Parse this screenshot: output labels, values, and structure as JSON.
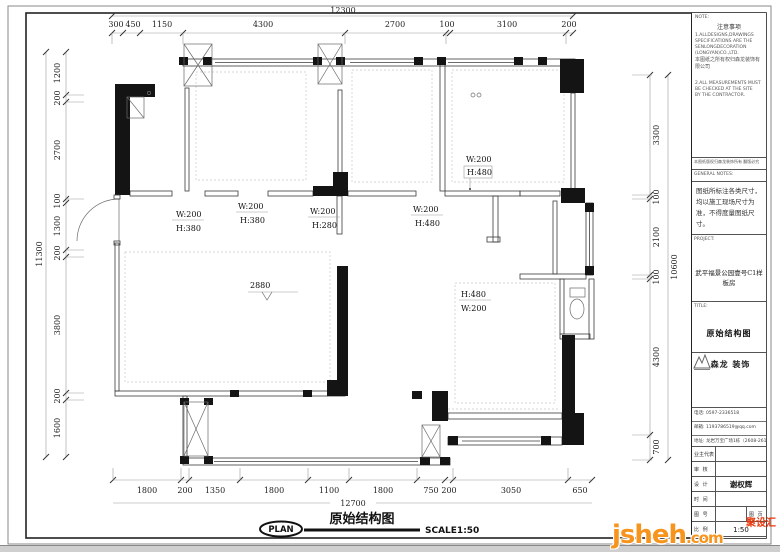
{
  "sheet": {
    "plan": {
      "title": "原始结构图",
      "plan_badge": "PLAN",
      "scale_note": "SCALE1:50",
      "floor_height": "2880",
      "wall_labels": [
        {
          "w": "W:200",
          "h": "H:380"
        },
        {
          "w": "W:200",
          "h": "H:380"
        },
        {
          "w": "W:200",
          "h": "H:280"
        },
        {
          "w": "W:200",
          "h": "H:480"
        },
        {
          "w": "W:200",
          "h": "H:480"
        },
        {
          "w": "W:200",
          "h": "H:480"
        }
      ],
      "dims": {
        "top_total": "12300",
        "top": [
          "300",
          "450",
          "1150",
          "4300",
          "2700",
          "100",
          "3100",
          "200"
        ],
        "left_total": "11300",
        "left": [
          "1200",
          "200",
          "2700",
          "100",
          "1300",
          "200",
          "3800",
          "200",
          "1600"
        ],
        "right_total": "10600",
        "right": [
          "3300",
          "100",
          "2100",
          "100",
          "4300",
          "700"
        ],
        "bottom_total": "12700",
        "bottom": [
          "1800",
          "200",
          "1350",
          "1800",
          "1100",
          "1800",
          "750",
          "200",
          "3050",
          "650"
        ]
      }
    },
    "titleblock": {
      "note_label": "NOTE:",
      "note_title": "注意事项",
      "note_lines": [
        "1.ALLDESIGNS,DRAWINGS",
        "SPECIFICATIONS ARE THE",
        "SENLONGDECORATION",
        "(LONGYAN)CO.,LTD.",
        "本图纸之所有权归森龙装饰有限公司",
        "",
        "2.ALL MEASUREMENTS MUST",
        "BE CHECKED AT THE SITE",
        "BY THE CONTRACTOR."
      ],
      "copyright_line": "本图纸版权归森龙装饰所有 翻版必究",
      "general_notes_label": "GENERAL NOTES:",
      "general_notes": "图纸所标注各类尺寸，均以施工现场尺寸为准，不得度量图纸尺寸。",
      "project_label": "PROJECT:",
      "project_name": "武平福景公园壹号C1样板房",
      "title_label": "TITLE:",
      "drawing_title": "原始结构图",
      "company_name": "森龙 装饰",
      "contacts": {
        "phone": "电话: 0597-2336518",
        "email": "邮箱: 1193786519@qq.com",
        "address": "地址: 龙岩万宝广场1栋（2608-2611）"
      },
      "fields": {
        "owner_label": "业主代表",
        "owner": "",
        "review_label": "审 核",
        "review": "",
        "design_label": "设 计",
        "designer": "谢权辉",
        "date_label": "时 间",
        "date": "",
        "sheet_no_label": "图 号",
        "sheet_page_label": "图 页",
        "scale_label": "比 例",
        "scale": "1:50"
      },
      "watermark": {
        "main": "jsheh",
        "tld": ".com",
        "badge": "聚设汇"
      }
    }
  }
}
